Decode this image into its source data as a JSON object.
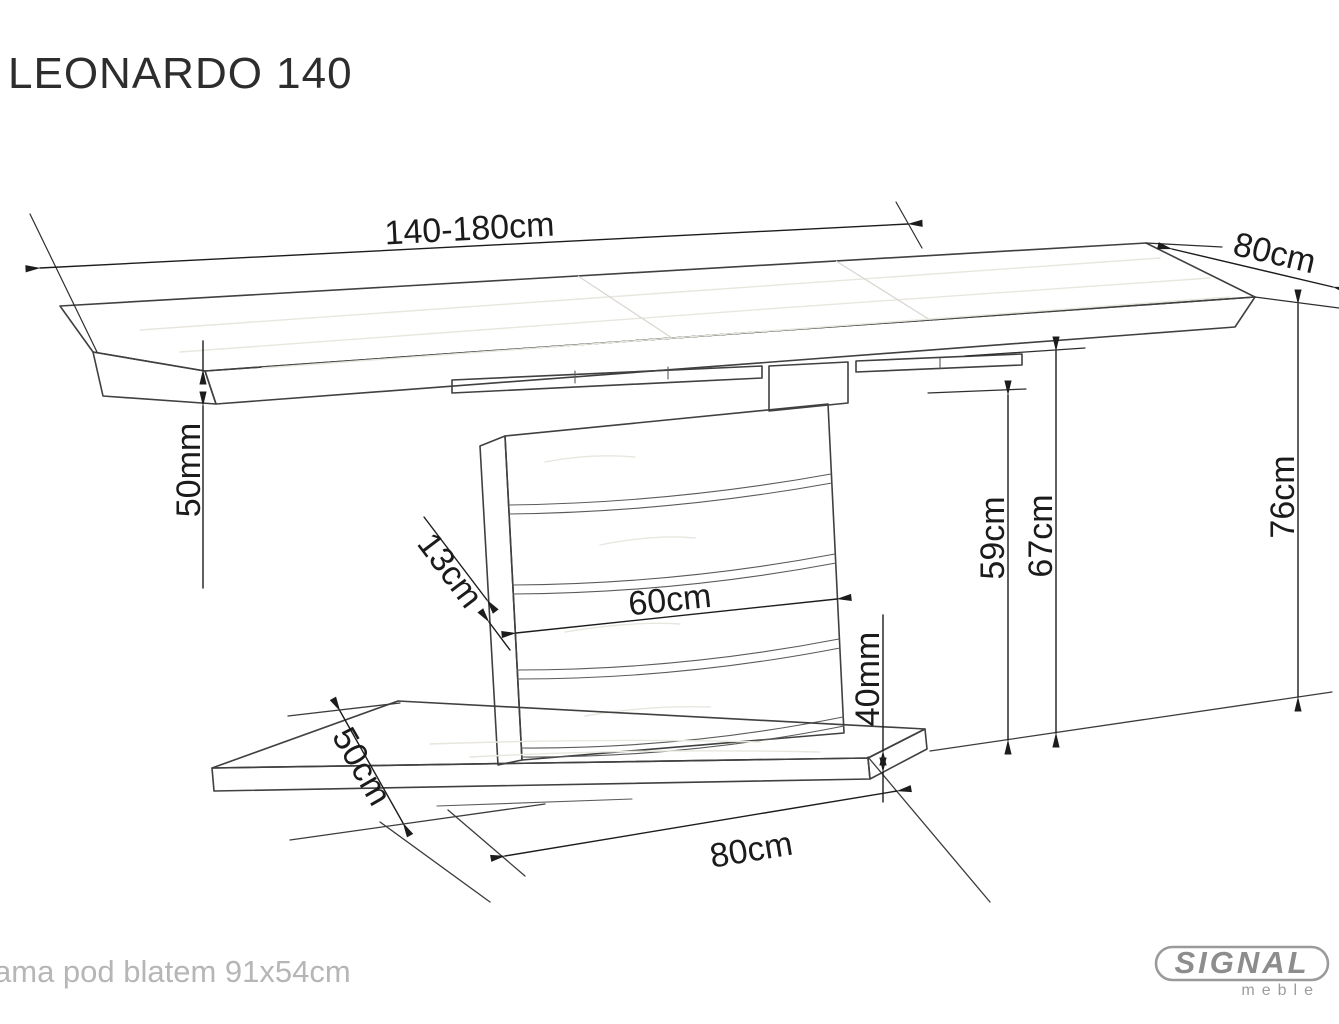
{
  "title": "LEONARDO 140",
  "dimensions": {
    "table_length": "140-180cm",
    "table_depth": "80cm",
    "top_thickness": "50mm",
    "slat_width": "13cm",
    "column_width": "60cm",
    "underframe_height": "59cm",
    "underside_height": "67cm",
    "table_height": "76cm",
    "base_thickness": "40mm",
    "base_depth": "50cm",
    "base_length": "80cm"
  },
  "footer": {
    "note": "ama pod blatem 91x54cm"
  },
  "logo": {
    "brand": "SIGNAL",
    "subtitle": "meble",
    "color": "#8d8d8d"
  }
}
